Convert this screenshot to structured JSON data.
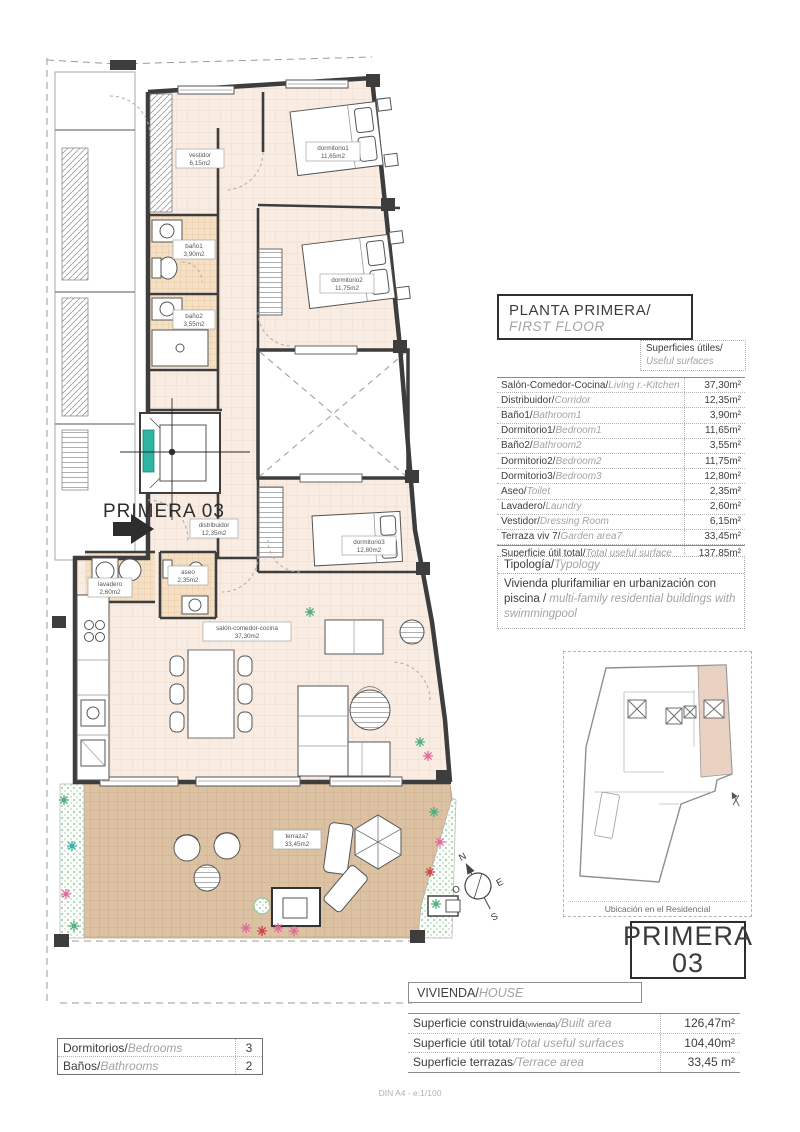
{
  "header": {
    "title_es": "PLANTA PRIMERA/",
    "title_en": "FIRST FLOOR"
  },
  "surfaces": {
    "caption_es": "Superficies útiles/",
    "caption_en": "Useful surfaces",
    "rows": [
      {
        "es": "Salón-Comedor-Cocina/",
        "en": "Living r.-Kitchen",
        "value": "37,30m²"
      },
      {
        "es": "Distribuidor/",
        "en": "Corridor",
        "value": "12,35m²"
      },
      {
        "es": "Baño1/",
        "en": "Bathroom1",
        "value": "3,90m²"
      },
      {
        "es": "Dormitorio1/",
        "en": "Bedroom1",
        "value": "11,65m²"
      },
      {
        "es": "Baño2/",
        "en": "Bathroom2",
        "value": "3,55m²"
      },
      {
        "es": "Dormitorio2/",
        "en": "Bedroom2",
        "value": "11,75m²"
      },
      {
        "es": "Dormitorio3/",
        "en": "Bedroom3",
        "value": "12,80m²"
      },
      {
        "es": "Aseo/",
        "en": "Toilet",
        "value": "2,35m²"
      },
      {
        "es": "Lavadero/",
        "en": "Laundry",
        "value": "2,60m²"
      },
      {
        "es": "Vestidor/",
        "en": "Dressing Room",
        "value": "6,15m²"
      },
      {
        "es": "Terraza viv 7/",
        "en": "Garden area7",
        "value": "33,45m²"
      },
      {
        "es": "Superficie útil total/",
        "en": "Total useful surface",
        "value": "137,85m²"
      }
    ]
  },
  "typology": {
    "title_es": "Tipología/",
    "title_en": "Typology",
    "body_es": "Vivienda plurifamiliar en urbanización con piscina",
    "body_sep": " / ",
    "body_en": "multi-family residential buildings with swimmingpool"
  },
  "location": {
    "caption": "Ubicación en el Residencial"
  },
  "unit_badge": {
    "line1": "PRIMERA",
    "line2": "03"
  },
  "house": {
    "label_es": "VIVIENDA/",
    "label_en": "HOUSE",
    "rows": [
      {
        "es": "Superficie construida",
        "sub": "(vivienda)",
        "en": "/Built area",
        "value": "126,47m²"
      },
      {
        "es": "Superficie útil total",
        "sub": "",
        "en": "/Total useful surfaces",
        "value": "104,40m²"
      },
      {
        "es": "Superficie terrazas",
        "sub": "",
        "en": "/Terrace area",
        "value": "33,45 m²"
      }
    ]
  },
  "counts": {
    "rows": [
      {
        "es": "Dormitorios/",
        "en": "Bedrooms",
        "value": "3"
      },
      {
        "es": "Baños/",
        "en": "Bathrooms",
        "value": "2"
      }
    ]
  },
  "plan": {
    "unit_label": "PRIMERA 03",
    "rooms": [
      {
        "name": "vestidor",
        "area": "6,15m2"
      },
      {
        "name": "dormitorio1",
        "area": "11,65m2"
      },
      {
        "name": "baño1",
        "area": "3,90m2"
      },
      {
        "name": "baño2",
        "area": "3,55m2"
      },
      {
        "name": "dormitorio2",
        "area": "11,75m2"
      },
      {
        "name": "dormitorio3",
        "area": "12,80m2"
      },
      {
        "name": "distribuidor",
        "area": "12,35m2"
      },
      {
        "name": "aseo",
        "area": "2,35m2"
      },
      {
        "name": "lavadero",
        "area": "2,60m2"
      },
      {
        "name": "salón-comedor-cocina",
        "area": "37,30m2"
      },
      {
        "name": "terraza7",
        "area": "33,45m2"
      }
    ],
    "compass": {
      "n": "N",
      "s": "S",
      "e": "E",
      "o": "O"
    }
  },
  "colors": {
    "room_fill": "#f9ece3",
    "tile_fill": "#f5e0c6",
    "terrace_fill": "#dcc2a3",
    "wall": "#3d3d3d",
    "accent_teal": "#2fb3a3",
    "plant_green": "#4caf7d",
    "plant_pink": "#e06a9a"
  },
  "page": {
    "footer": "DIN A4 - e:1/100"
  }
}
